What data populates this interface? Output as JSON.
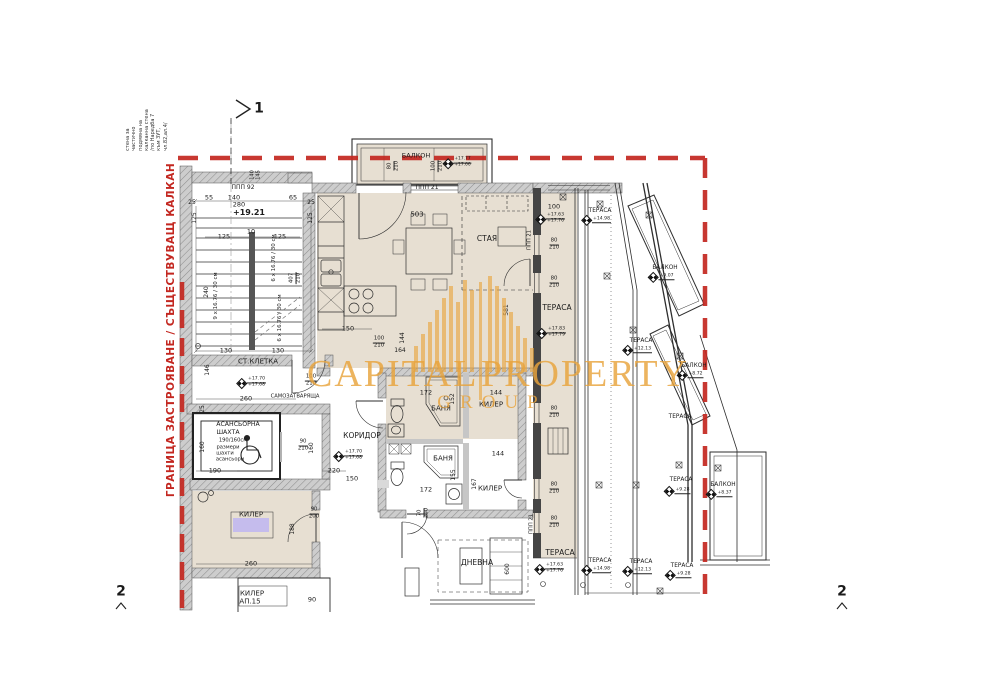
{
  "watermark": {
    "line1": "CAPITAL",
    "line2": "PROPERTY",
    "line3": "GROUP",
    "color": "#E9A43C"
  },
  "boundary": {
    "label": "ГРАНИЦА ЗАСТРОЯВАНЕ / СЪЩЕСТВУВАЩ КАЛКАН",
    "color": "#C32720"
  },
  "note": {
    "text": "стена за\nчастично\nподмяна на\nкалканна стена\n/по Наредба 7\nкъм ЗУТ,\nчл.82,ал.4/"
  },
  "colors": {
    "red": "#C32720",
    "beige": "#E7DFD2",
    "wall_gray": "#CDCDCD",
    "purple": "#C5BCED",
    "orange": "#E9A43C"
  },
  "section_marks": {
    "top": "1",
    "bottom_left": "2",
    "bottom_right": "2"
  },
  "labels": [
    {
      "n": "section-mark-1",
      "t": "1",
      "x": 259,
      "y": 109,
      "s": 14,
      "w": 1
    },
    {
      "n": "section-mark-2-left",
      "t": "2",
      "x": 121,
      "y": 592,
      "s": 14,
      "w": 1
    },
    {
      "n": "section-mark-2-right",
      "t": "2",
      "x": 842,
      "y": 592,
      "s": 14,
      "w": 1
    },
    {
      "t": "ППП 92",
      "x": 243,
      "y": 188,
      "s": 6
    },
    {
      "t": "140",
      "x": 253,
      "y": 175,
      "r": -90,
      "s": 5
    },
    {
      "t": "145",
      "x": 259,
      "y": 175,
      "r": -90,
      "s": 5
    },
    {
      "t": "55",
      "x": 209,
      "y": 198,
      "s": 6.5
    },
    {
      "t": "140",
      "x": 234,
      "y": 198,
      "s": 6.5
    },
    {
      "t": "65",
      "x": 293,
      "y": 198,
      "s": 6.5
    },
    {
      "t": "280",
      "x": 239,
      "y": 205,
      "s": 6.5
    },
    {
      "t": "25",
      "x": 192,
      "y": 203,
      "s": 6
    },
    {
      "t": "25",
      "x": 311,
      "y": 203,
      "s": 6
    },
    {
      "t": "+19.21",
      "x": 249,
      "y": 213,
      "s": 8,
      "w": 1
    },
    {
      "t": "125",
      "x": 195,
      "y": 218,
      "r": -90,
      "s": 6
    },
    {
      "t": "125",
      "x": 311,
      "y": 218,
      "r": -90,
      "s": 6
    },
    {
      "t": "10",
      "x": 251,
      "y": 232,
      "s": 6.5
    },
    {
      "t": "125",
      "x": 224,
      "y": 237,
      "s": 6.5
    },
    {
      "t": "125",
      "x": 280,
      "y": 237,
      "s": 6.5
    },
    {
      "t": "9 x 16.76 / 30 см",
      "x": 217,
      "y": 296,
      "r": -90,
      "s": 5.5
    },
    {
      "t": "240",
      "x": 207,
      "y": 292,
      "r": -90,
      "s": 6
    },
    {
      "t": "6 x 16.76 / 30 см",
      "x": 275,
      "y": 258,
      "r": -90,
      "s": 5.5
    },
    {
      "t": "6 x 16.76 / 30 см",
      "x": 281,
      "y": 318,
      "r": -90,
      "s": 5.5
    },
    {
      "type": "frac",
      "a": "407",
      "b": "210",
      "x": 296,
      "y": 278,
      "r": -90
    },
    {
      "t": "130",
      "x": 226,
      "y": 351,
      "s": 6.5
    },
    {
      "t": "130",
      "x": 278,
      "y": 351,
      "s": 6.5
    },
    {
      "n": "room-label-staircase",
      "t": "СТ.КЛЕТКА",
      "x": 258,
      "y": 362,
      "s": 7
    },
    {
      "t": "146",
      "x": 208,
      "y": 370,
      "r": -90,
      "s": 6
    },
    {
      "type": "elev",
      "a": "+17.70",
      "b": "+17.68",
      "x": 252,
      "y": 383
    },
    {
      "type": "frac",
      "a": "100",
      "b": "210",
      "x": 311,
      "y": 381
    },
    {
      "t": "САМОЗАТВАРЯЩА",
      "x": 295,
      "y": 397,
      "s": 5.2
    },
    {
      "t": "260",
      "x": 246,
      "y": 399,
      "s": 6.5
    },
    {
      "t": "25",
      "x": 203,
      "y": 409,
      "r": -90,
      "s": 6
    },
    {
      "n": "room-label-elevator",
      "t": "АСАНСЬОРНА",
      "x": 238,
      "y": 425,
      "s": 6.2
    },
    {
      "t": "ШАХТА",
      "x": 228,
      "y": 433,
      "s": 6.2
    },
    {
      "t": "190/160см",
      "x": 233,
      "y": 441,
      "s": 5.2
    },
    {
      "t": "размери",
      "x": 228,
      "y": 447.5,
      "s": 5.2
    },
    {
      "t": "шахти",
      "x": 225,
      "y": 453.5,
      "s": 5.2
    },
    {
      "t": "асансьори",
      "x": 230,
      "y": 459.5,
      "s": 5.2
    },
    {
      "t": "160",
      "x": 203,
      "y": 447,
      "r": -90,
      "s": 6
    },
    {
      "t": "190",
      "x": 215,
      "y": 471,
      "s": 6.5
    },
    {
      "type": "frac",
      "a": "90",
      "b": "210",
      "x": 303,
      "y": 446
    },
    {
      "t": "160",
      "x": 312,
      "y": 448,
      "r": -90,
      "s": 6
    },
    {
      "t": "220",
      "x": 334,
      "y": 471,
      "s": 6.5
    },
    {
      "t": "150",
      "x": 352,
      "y": 479,
      "s": 6.5
    },
    {
      "n": "room-label-corridor",
      "t": "КОРИДОР",
      "x": 362,
      "y": 436,
      "s": 7.5
    },
    {
      "type": "elev",
      "a": "+17.70",
      "b": "+17.68",
      "x": 349,
      "y": 456
    },
    {
      "n": "room-label-balcony",
      "t": "БАЛКОН",
      "x": 416,
      "y": 156,
      "s": 6.5
    },
    {
      "type": "frac",
      "a": "80",
      "b": "210",
      "x": 394,
      "y": 166,
      "r": -90
    },
    {
      "type": "frac",
      "a": "100",
      "b": "210",
      "x": 438,
      "y": 166,
      "r": -90
    },
    {
      "type": "elev",
      "a": "+17.77",
      "b": "+17.66",
      "x": 458,
      "y": 163,
      "s": 4.4
    },
    {
      "t": "ППП 21",
      "x": 427,
      "y": 188,
      "s": 6
    },
    {
      "t": "503",
      "x": 417,
      "y": 215,
      "s": 7
    },
    {
      "n": "room-label-staya",
      "t": "СТАЯ",
      "x": 487,
      "y": 239,
      "s": 7.5
    },
    {
      "t": "150",
      "x": 348,
      "y": 329,
      "s": 6.5
    },
    {
      "t": "581",
      "x": 507,
      "y": 310,
      "r": -90,
      "s": 6
    },
    {
      "t": "144",
      "x": 403,
      "y": 338,
      "r": -90,
      "s": 6
    },
    {
      "type": "frac",
      "a": "100",
      "b": "210",
      "x": 379,
      "y": 343
    },
    {
      "t": "164",
      "x": 400,
      "y": 351,
      "s": 6
    },
    {
      "t": "ППП 21",
      "x": 530,
      "y": 240,
      "r": -90,
      "s": 5.2
    },
    {
      "t": "ППП 21",
      "x": 532,
      "y": 524,
      "r": -90,
      "s": 5.2
    },
    {
      "t": "172",
      "x": 426,
      "y": 393,
      "s": 6.5
    },
    {
      "t": "152",
      "x": 453,
      "y": 399,
      "r": -90,
      "s": 6
    },
    {
      "n": "room-label-bath-1",
      "t": "БАНЯ",
      "x": 441,
      "y": 409,
      "s": 7
    },
    {
      "t": "144",
      "x": 496,
      "y": 393,
      "s": 6.5
    },
    {
      "n": "room-label-kiler-1",
      "t": "КИЛЕР",
      "x": 491,
      "y": 405,
      "s": 7
    },
    {
      "n": "room-label-bath-2",
      "t": "БАНЯ",
      "x": 443,
      "y": 459,
      "s": 7
    },
    {
      "t": "155",
      "x": 454,
      "y": 475,
      "r": -90,
      "s": 6
    },
    {
      "t": "172",
      "x": 426,
      "y": 490,
      "s": 6.5
    },
    {
      "type": "frac",
      "a": "70",
      "b": "200",
      "x": 424,
      "y": 513,
      "r": -90
    },
    {
      "t": "167",
      "x": 475,
      "y": 484,
      "r": -90,
      "s": 6
    },
    {
      "t": "144",
      "x": 498,
      "y": 454,
      "s": 6.5
    },
    {
      "n": "room-label-kiler-2",
      "t": "КИЛЕР",
      "x": 490,
      "y": 489,
      "s": 7
    },
    {
      "n": "room-label-kiler-3",
      "t": "КИЛЕР",
      "x": 251,
      "y": 515,
      "s": 7
    },
    {
      "type": "frac",
      "a": "90",
      "b": "200",
      "x": 314,
      "y": 514
    },
    {
      "t": "188",
      "x": 293,
      "y": 529,
      "r": -90,
      "s": 6
    },
    {
      "t": "260",
      "x": 251,
      "y": 564,
      "s": 6.5
    },
    {
      "n": "room-label-kiler-ap15",
      "t": "КИЛЕР",
      "x": 252,
      "y": 594,
      "s": 7
    },
    {
      "t": "АП.15",
      "x": 250,
      "y": 602,
      "s": 7
    },
    {
      "t": "90",
      "x": 312,
      "y": 600,
      "s": 6.5
    },
    {
      "n": "room-label-dnevna",
      "t": "ДНЕВНА",
      "x": 477,
      "y": 563,
      "s": 7.5
    },
    {
      "t": "600",
      "x": 508,
      "y": 569,
      "r": -90,
      "s": 6
    },
    {
      "t": "100",
      "x": 554,
      "y": 207,
      "s": 6.5
    },
    {
      "type": "elev",
      "a": "+17.63",
      "b": "+17.76",
      "x": 551,
      "y": 219
    },
    {
      "type": "frac",
      "a": "80",
      "b": "210",
      "x": 554,
      "y": 245
    },
    {
      "type": "frac",
      "a": "80",
      "b": "210",
      "x": 554,
      "y": 283
    },
    {
      "n": "room-label-terrace-main",
      "t": "ТЕРАСА",
      "x": 557,
      "y": 308,
      "s": 7.5
    },
    {
      "type": "elev",
      "a": "+17.83",
      "b": "+17.79",
      "x": 552,
      "y": 333
    },
    {
      "type": "frac",
      "a": "80",
      "b": "210",
      "x": 554,
      "y": 413
    },
    {
      "type": "frac",
      "a": "80",
      "b": "210",
      "x": 554,
      "y": 489
    },
    {
      "type": "frac",
      "a": "80",
      "b": "210",
      "x": 554,
      "y": 523
    },
    {
      "n": "room-label-terrace-main-2",
      "t": "ТЕРАСА",
      "x": 560,
      "y": 553,
      "s": 7.5
    },
    {
      "type": "elev",
      "a": "+17.63",
      "b": "+17.76",
      "x": 550,
      "y": 569
    },
    {
      "n": "room-label-terrace-1498",
      "t": "ТЕРАСА",
      "x": 600,
      "y": 211,
      "s": 5.8
    },
    {
      "type": "elev",
      "a": "+14.98",
      "x": 597,
      "y": 220
    },
    {
      "n": "room-label-balkon-1",
      "t": "БАЛКОН",
      "x": 665,
      "y": 268,
      "s": 5.8
    },
    {
      "type": "elev",
      "a": "+9.07",
      "x": 662,
      "y": 277
    },
    {
      "n": "room-label-terrace-1213",
      "t": "ТЕРАСА",
      "x": 641,
      "y": 341,
      "s": 5.8
    },
    {
      "type": "elev",
      "a": "+12.13",
      "x": 638,
      "y": 350
    },
    {
      "n": "room-label-balkon-2",
      "t": "БАЛКОН",
      "x": 694,
      "y": 366,
      "s": 5.8
    },
    {
      "type": "elev",
      "a": "+8.72",
      "x": 691,
      "y": 375
    },
    {
      "t": "ТЕРАСА",
      "x": 680,
      "y": 417,
      "s": 5.8
    },
    {
      "t": "ТЕРАСА",
      "x": 681,
      "y": 480,
      "s": 5.8
    },
    {
      "type": "elev",
      "a": "+9.28",
      "x": 678,
      "y": 491
    },
    {
      "n": "room-label-balkon-3",
      "t": "БАЛКОН",
      "x": 723,
      "y": 485,
      "s": 5.8
    },
    {
      "type": "elev",
      "a": "+8.37",
      "x": 720,
      "y": 494
    },
    {
      "t": "ТЕРАСА",
      "x": 600,
      "y": 561,
      "s": 5.8
    },
    {
      "type": "elev",
      "a": "+14.98",
      "x": 597,
      "y": 570
    },
    {
      "t": "ТЕРАСА",
      "x": 641,
      "y": 562,
      "s": 5.8
    },
    {
      "type": "elev",
      "a": "+12.13",
      "x": 638,
      "y": 571
    },
    {
      "t": "ТЕРАСА",
      "x": 682,
      "y": 566,
      "s": 5.8
    },
    {
      "type": "elev",
      "a": "+9.28",
      "x": 679,
      "y": 575
    }
  ]
}
